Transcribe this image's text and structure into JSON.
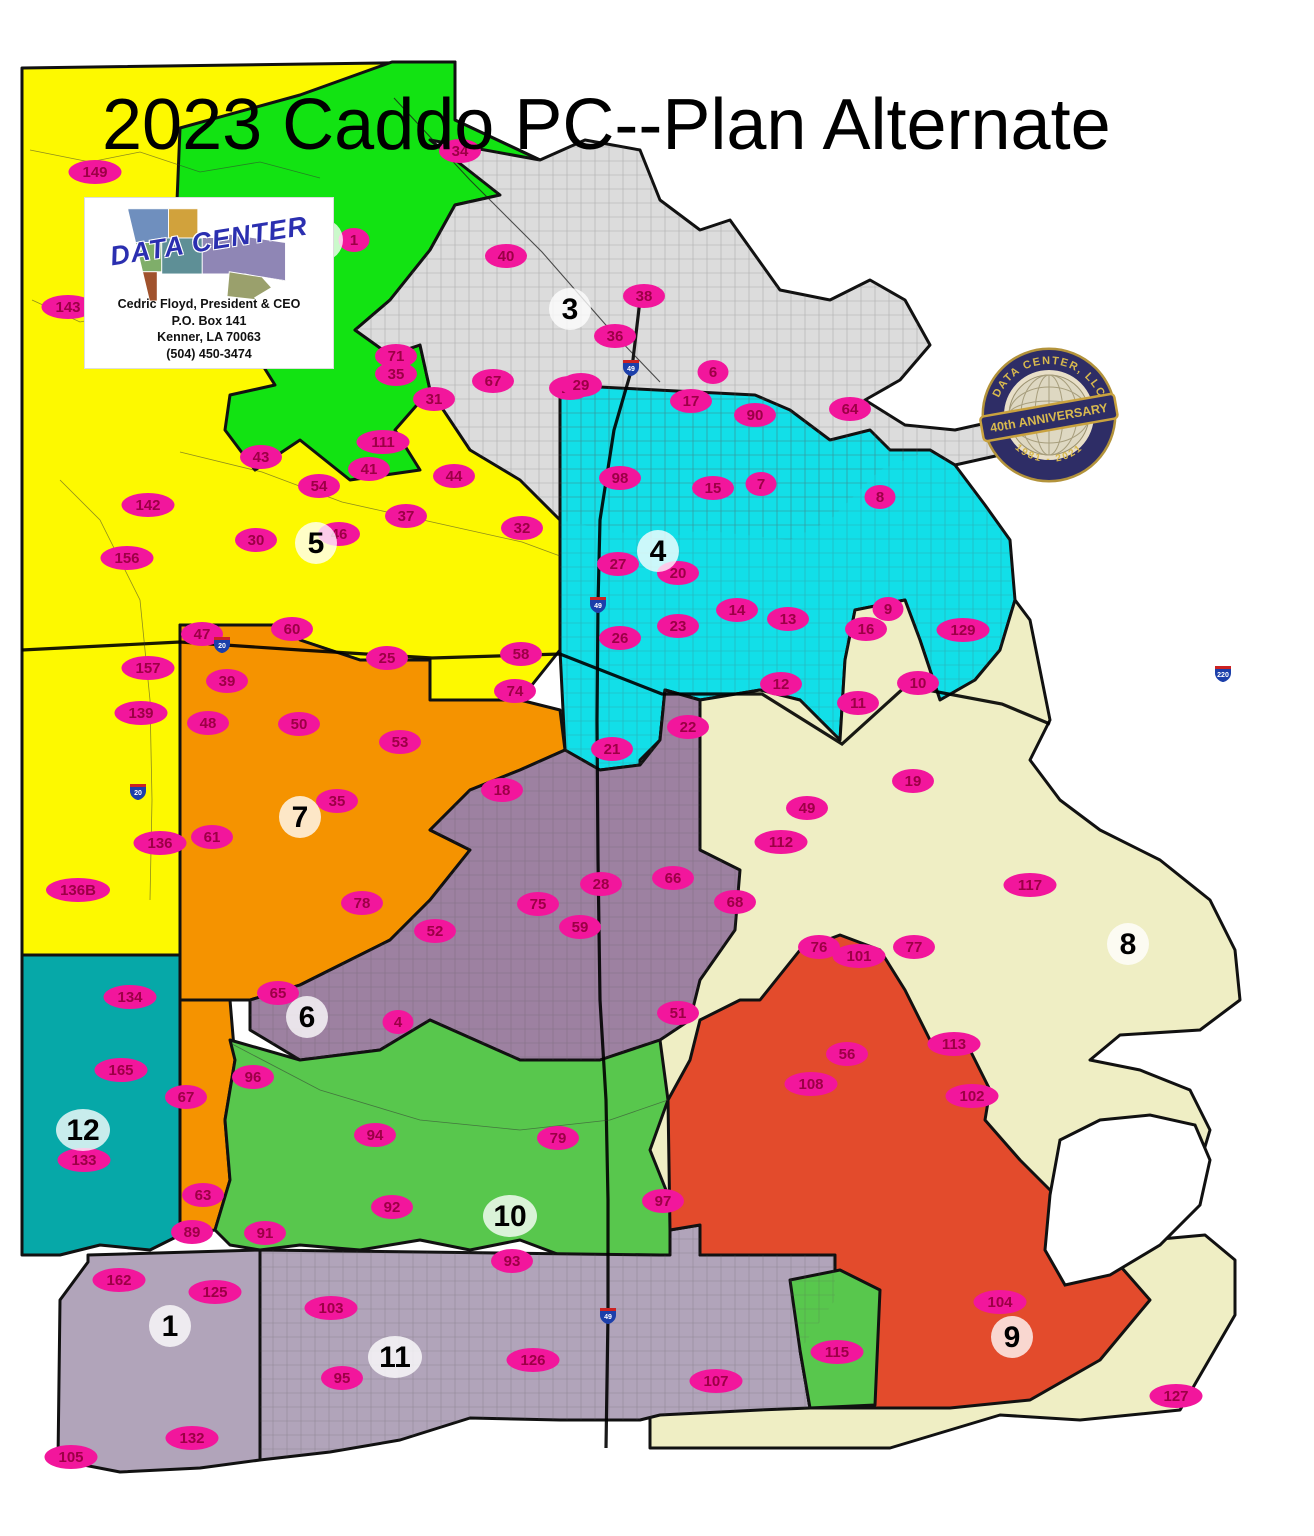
{
  "title": "2023 Caddo PC--Plan Alternate",
  "logo": {
    "name": "DATA CENTER",
    "line1": "Cedric Floyd, President & CEO",
    "line2": "P.O. Box 141",
    "line3": "Kenner, LA  70063",
    "line4": "(504) 450-3474"
  },
  "badge": {
    "top": "DATA CENTER, LLC",
    "banner": "40th ANNIVERSARY",
    "bottom": "1981 - 2021"
  },
  "colors": {
    "precinct_fill": "#f2169c",
    "precinct_text": "#9c0045",
    "district_label_bg": "#ffffff",
    "district_label_text": "#000000",
    "outline": "#111111",
    "shield_blue": "#1c3faa",
    "shield_red": "#cc2222"
  },
  "districts": [
    {
      "id": 1,
      "label": "1",
      "color": "#b1a4ba",
      "label_x": 170,
      "label_y": 1326
    },
    {
      "id": 2,
      "label": "2",
      "color": "#12e312",
      "label_x": 322,
      "label_y": 240
    },
    {
      "id": 3,
      "label": "3",
      "color": "#dcdcdc",
      "label_x": 570,
      "label_y": 309
    },
    {
      "id": 4,
      "label": "4",
      "color": "#12dfe8",
      "label_x": 658,
      "label_y": 551
    },
    {
      "id": 5,
      "label": "5",
      "color": "#fdf900",
      "label_x": 316,
      "label_y": 543
    },
    {
      "id": 6,
      "label": "6",
      "color": "#9d81a1",
      "label_x": 307,
      "label_y": 1017
    },
    {
      "id": 7,
      "label": "7",
      "color": "#f59300",
      "label_x": 300,
      "label_y": 817
    },
    {
      "id": 8,
      "label": "8",
      "color": "#efeec4",
      "label_x": 1128,
      "label_y": 944
    },
    {
      "id": 9,
      "label": "9",
      "color": "#e34b2c",
      "label_x": 1012,
      "label_y": 1337
    },
    {
      "id": 10,
      "label": "10",
      "color": "#58c74d",
      "label_x": 510,
      "label_y": 1216
    },
    {
      "id": 11,
      "label": "11",
      "color": "#b1a4ba",
      "label_x": 395,
      "label_y": 1357
    },
    {
      "id": 12,
      "label": "12",
      "color": "#06a8a8",
      "label_x": 83,
      "label_y": 1130
    }
  ],
  "precincts": [
    {
      "n": "149",
      "x": 95,
      "y": 172
    },
    {
      "n": "143",
      "x": 68,
      "y": 307
    },
    {
      "n": "142",
      "x": 148,
      "y": 505
    },
    {
      "n": "156",
      "x": 127,
      "y": 558
    },
    {
      "n": "157",
      "x": 148,
      "y": 668
    },
    {
      "n": "139",
      "x": 141,
      "y": 713
    },
    {
      "n": "47",
      "x": 202,
      "y": 634
    },
    {
      "n": "136",
      "x": 160,
      "y": 843
    },
    {
      "n": "136B",
      "x": 78,
      "y": 890
    },
    {
      "n": "134",
      "x": 130,
      "y": 997
    },
    {
      "n": "165",
      "x": 121,
      "y": 1070
    },
    {
      "n": "133",
      "x": 84,
      "y": 1160
    },
    {
      "n": "162",
      "x": 119,
      "y": 1280
    },
    {
      "n": "125",
      "x": 215,
      "y": 1292
    },
    {
      "n": "132",
      "x": 192,
      "y": 1438
    },
    {
      "n": "105",
      "x": 71,
      "y": 1457
    },
    {
      "n": "135",
      "x": 201,
      "y": 258
    },
    {
      "n": "1",
      "x": 354,
      "y": 240
    },
    {
      "n": "55",
      "x": 262,
      "y": 337
    },
    {
      "n": "71",
      "x": 396,
      "y": 356
    },
    {
      "n": "111",
      "x": 383,
      "y": 442
    },
    {
      "n": "43",
      "x": 261,
      "y": 457
    },
    {
      "n": "34",
      "x": 460,
      "y": 151
    },
    {
      "n": "40",
      "x": 506,
      "y": 256
    },
    {
      "n": "38",
      "x": 644,
      "y": 296
    },
    {
      "n": "36",
      "x": 615,
      "y": 336
    },
    {
      "n": "35",
      "x": 396,
      "y": 374
    },
    {
      "n": "67",
      "x": 493,
      "y": 381
    },
    {
      "n": "31",
      "x": 434,
      "y": 399
    },
    {
      "n": "24",
      "x": 570,
      "y": 388
    },
    {
      "n": "6",
      "x": 713,
      "y": 372
    },
    {
      "n": "90",
      "x": 755,
      "y": 415
    },
    {
      "n": "64",
      "x": 850,
      "y": 409
    },
    {
      "n": "7",
      "x": 761,
      "y": 484
    },
    {
      "n": "8",
      "x": 880,
      "y": 497
    },
    {
      "n": "32",
      "x": 522,
      "y": 528
    },
    {
      "n": "41",
      "x": 369,
      "y": 469
    },
    {
      "n": "44",
      "x": 454,
      "y": 476
    },
    {
      "n": "54",
      "x": 319,
      "y": 486
    },
    {
      "n": "37",
      "x": 406,
      "y": 516
    },
    {
      "n": "46",
      "x": 339,
      "y": 534
    },
    {
      "n": "30",
      "x": 256,
      "y": 540
    },
    {
      "n": "25",
      "x": 387,
      "y": 658
    },
    {
      "n": "39",
      "x": 227,
      "y": 681
    },
    {
      "n": "58",
      "x": 521,
      "y": 654
    },
    {
      "n": "60",
      "x": 292,
      "y": 629
    },
    {
      "n": "48",
      "x": 208,
      "y": 723
    },
    {
      "n": "50",
      "x": 299,
      "y": 724
    },
    {
      "n": "53",
      "x": 400,
      "y": 742
    },
    {
      "n": "35",
      "x": 337,
      "y": 801
    },
    {
      "n": "61",
      "x": 212,
      "y": 837
    },
    {
      "n": "74",
      "x": 515,
      "y": 691
    },
    {
      "n": "18",
      "x": 502,
      "y": 790
    },
    {
      "n": "78",
      "x": 362,
      "y": 903
    },
    {
      "n": "52",
      "x": 435,
      "y": 931
    },
    {
      "n": "75",
      "x": 538,
      "y": 904
    },
    {
      "n": "59",
      "x": 580,
      "y": 927
    },
    {
      "n": "28",
      "x": 601,
      "y": 884
    },
    {
      "n": "65",
      "x": 278,
      "y": 993
    },
    {
      "n": "66",
      "x": 673,
      "y": 878
    },
    {
      "n": "68",
      "x": 735,
      "y": 902
    },
    {
      "n": "51",
      "x": 678,
      "y": 1013
    },
    {
      "n": "4",
      "x": 398,
      "y": 1022
    },
    {
      "n": "29",
      "x": 581,
      "y": 385
    },
    {
      "n": "17",
      "x": 691,
      "y": 401
    },
    {
      "n": "98",
      "x": 620,
      "y": 478
    },
    {
      "n": "15",
      "x": 713,
      "y": 488
    },
    {
      "n": "27",
      "x": 618,
      "y": 564
    },
    {
      "n": "20",
      "x": 678,
      "y": 573
    },
    {
      "n": "14",
      "x": 737,
      "y": 610
    },
    {
      "n": "13",
      "x": 788,
      "y": 619
    },
    {
      "n": "23",
      "x": 678,
      "y": 626
    },
    {
      "n": "26",
      "x": 620,
      "y": 638
    },
    {
      "n": "9",
      "x": 888,
      "y": 609
    },
    {
      "n": "129",
      "x": 963,
      "y": 630
    },
    {
      "n": "21",
      "x": 612,
      "y": 749
    },
    {
      "n": "22",
      "x": 688,
      "y": 727
    },
    {
      "n": "16",
      "x": 866,
      "y": 629
    },
    {
      "n": "10",
      "x": 918,
      "y": 683
    },
    {
      "n": "12",
      "x": 781,
      "y": 684
    },
    {
      "n": "11",
      "x": 858,
      "y": 703
    },
    {
      "n": "19",
      "x": 913,
      "y": 781
    },
    {
      "n": "49",
      "x": 807,
      "y": 808
    },
    {
      "n": "112",
      "x": 781,
      "y": 842
    },
    {
      "n": "117",
      "x": 1030,
      "y": 885
    },
    {
      "n": "76",
      "x": 819,
      "y": 947
    },
    {
      "n": "77",
      "x": 914,
      "y": 947
    },
    {
      "n": "101",
      "x": 859,
      "y": 956
    },
    {
      "n": "127",
      "x": 1176,
      "y": 1396
    },
    {
      "n": "113",
      "x": 954,
      "y": 1044
    },
    {
      "n": "56",
      "x": 847,
      "y": 1054
    },
    {
      "n": "108",
      "x": 811,
      "y": 1084
    },
    {
      "n": "102",
      "x": 972,
      "y": 1096
    },
    {
      "n": "104",
      "x": 1000,
      "y": 1302
    },
    {
      "n": "107",
      "x": 716,
      "y": 1381
    },
    {
      "n": "96",
      "x": 253,
      "y": 1077
    },
    {
      "n": "94",
      "x": 375,
      "y": 1135
    },
    {
      "n": "79",
      "x": 558,
      "y": 1138
    },
    {
      "n": "92",
      "x": 392,
      "y": 1207
    },
    {
      "n": "91",
      "x": 265,
      "y": 1233
    },
    {
      "n": "97",
      "x": 663,
      "y": 1201
    },
    {
      "n": "115",
      "x": 837,
      "y": 1352
    },
    {
      "n": "93",
      "x": 512,
      "y": 1261
    },
    {
      "n": "67",
      "x": 186,
      "y": 1097
    },
    {
      "n": "63",
      "x": 203,
      "y": 1195
    },
    {
      "n": "89",
      "x": 192,
      "y": 1232
    },
    {
      "n": "103",
      "x": 331,
      "y": 1308
    },
    {
      "n": "95",
      "x": 342,
      "y": 1378
    },
    {
      "n": "126",
      "x": 533,
      "y": 1360
    }
  ],
  "shields": [
    {
      "road": "49",
      "x": 631,
      "y": 367
    },
    {
      "road": "49",
      "x": 598,
      "y": 604
    },
    {
      "road": "20",
      "x": 222,
      "y": 644
    },
    {
      "road": "20",
      "x": 138,
      "y": 791
    },
    {
      "road": "220",
      "x": 1223,
      "y": 673
    },
    {
      "road": "49",
      "x": 608,
      "y": 1315
    }
  ]
}
